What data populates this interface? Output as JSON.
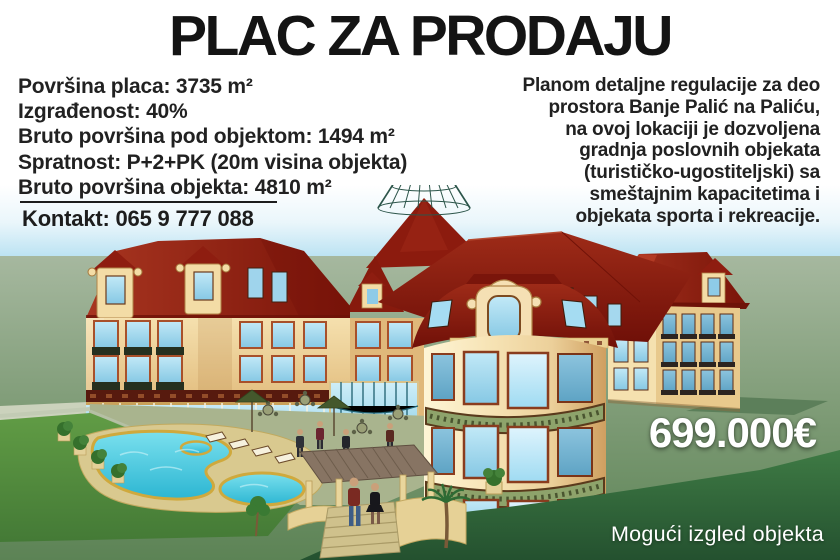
{
  "title": "PLAC ZA PRODAJU",
  "details": {
    "lines": [
      "Površina placa: 3735 m²",
      "Izgrađenost: 40%",
      "Bruto površina pod objektom: 1494 m²",
      "Spratnost: P+2+PK (20m visina objekta)",
      "Bruto površina objekta: 4810 m²"
    ],
    "contact": "Kontakt: 065 9 777 088"
  },
  "description": {
    "lines": [
      "Planom detaljne regulacije za deo",
      "prostora Banje Palić na Paliću,",
      "na ovoj lokaciji je dozvoljena",
      "gradnja poslovnih objekata",
      "(turističko-ugostiteljski) sa",
      "smeštajnim kapacitetima i",
      "objekata sporta i rekreacije."
    ]
  },
  "price": "699.000€",
  "caption": "Mogući izgled objekta",
  "colors": {
    "title_text": "#141414",
    "body_text": "#212121",
    "price_text": "#ffffff",
    "roof_red": "#8e1d10",
    "facade_cream": "#f0d7a2",
    "window_glass": "#8ed2ee",
    "pool_water": "#3cc8dc",
    "lawn_green": "#568c3f",
    "sky_blue": "#93d2ea"
  }
}
